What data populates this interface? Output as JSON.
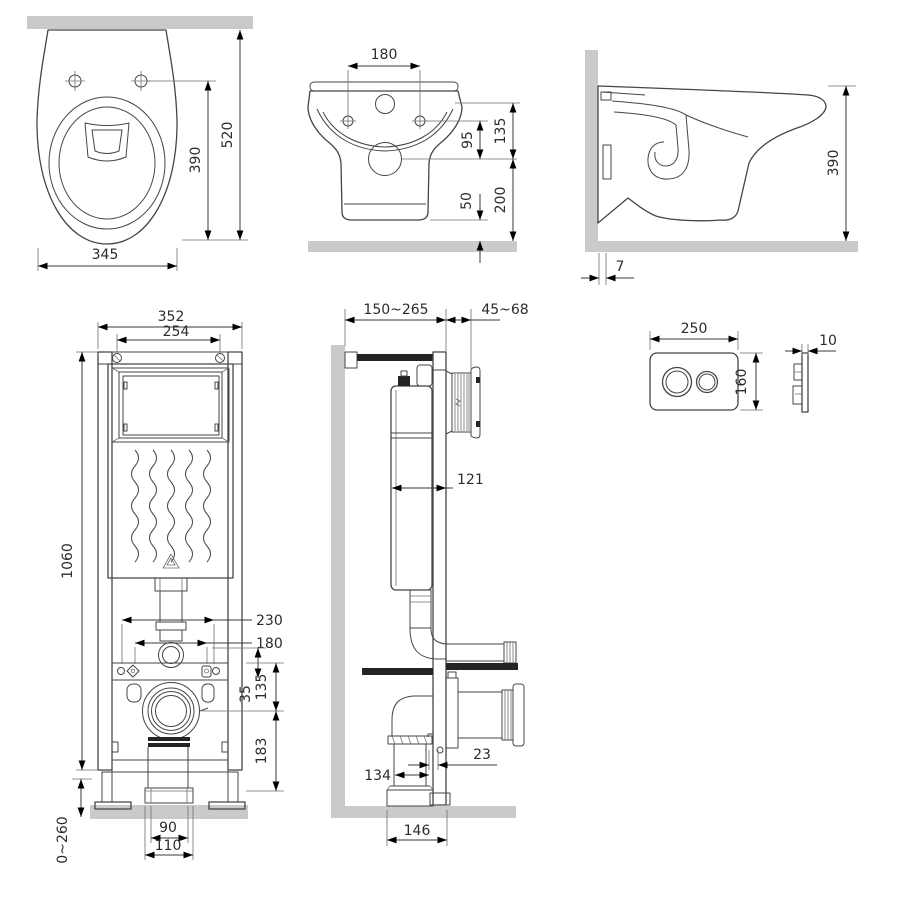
{
  "colors": {
    "background": "#ffffff",
    "wall_fill": "#cacaca",
    "line": "#454545",
    "dim_line": "#3a3a3a",
    "text": "#2c2c2c",
    "solid_black": "#242424"
  },
  "views": {
    "toilet_top": {
      "dims": {
        "width": "345",
        "holes_to_front": "390",
        "wall_to_front": "520"
      }
    },
    "toilet_front": {
      "dims": {
        "hole_spacing": "180",
        "holes_to_outlet": "95",
        "rim_to_outlet": "135",
        "bottom_clearance": "50",
        "outlet_height": "200"
      }
    },
    "toilet_side": {
      "dims": {
        "height": "390",
        "wall_gap": "7"
      }
    },
    "frame_front": {
      "dims": {
        "outer_width": "352",
        "inner_width": "254",
        "height": "1060",
        "conn_spacing": "230",
        "stud_spacing": "180",
        "pipe_to_rail": "35",
        "rail_to_outlet": "135",
        "outlet_to_base": "183",
        "leg_range": "0~260",
        "template_inner": "90",
        "template_outer": "110"
      }
    },
    "frame_side": {
      "dims": {
        "wall_to_front": "150~265",
        "panel_range": "45~68",
        "tank_depth": "121",
        "rail_offset": "23",
        "drain_offset": "134",
        "drain_to_front": "146"
      }
    },
    "flush_plate": {
      "dims": {
        "width": "250",
        "height": "160",
        "thickness": "10"
      }
    }
  }
}
